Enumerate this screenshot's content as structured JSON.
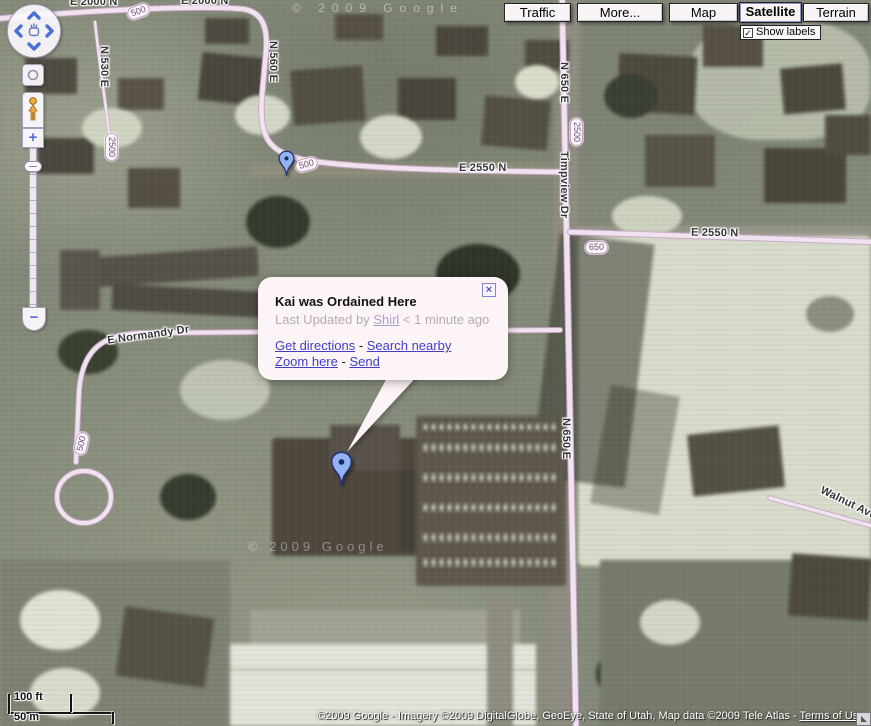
{
  "toolbar": {
    "traffic": "Traffic",
    "more": "More...",
    "map": "Map",
    "satellite": "Satellite",
    "terrain": "Terrain",
    "show_labels": "Show labels",
    "check_glyph": "✓"
  },
  "zoom_control": {
    "plus": "+",
    "minus": "−"
  },
  "bubble": {
    "title": "Kai was Ordained Here",
    "updated_prefix": "Last Updated by ",
    "author": "Shirl",
    "updated_suffix": " < 1 minute ago",
    "get_directions": "Get directions",
    "search_nearby": "Search nearby",
    "zoom_here": "Zoom here",
    "send": "Send",
    "dash": " - ",
    "close": "×"
  },
  "map_labels": {
    "roads": [
      "E 2000 N",
      "E 2000 N",
      "N 530 E",
      "N 560 E",
      "E 2550 N",
      "Timpview Dr",
      "N 650 E",
      "E 2550 N",
      "E Normandy Dr",
      "N 650 E",
      "Walnut Ave"
    ],
    "badges": [
      "500",
      "2500",
      "500",
      "2500",
      "650",
      "500"
    ]
  },
  "scale": {
    "imperial": "100 ft",
    "metric": "50 m"
  },
  "attribution": {
    "text": "©2009 Google - Imagery ©2009 DigitalGlobe, GeoEye, State of Utah, Map data ©2009 Tele Atlas - ",
    "terms": "Terms of Use"
  },
  "watermarks": {
    "top": "© 2009 Google",
    "middle": "© 2009 Google"
  },
  "colors": {
    "road_fill": "#f0e2ef",
    "road_casing": "#c9a6c6",
    "pin_fill": "#93b2f2",
    "pin_stroke": "#27336e",
    "link": "#4141c8",
    "accent_blue": "#4a70d8",
    "bubble_bg": "#fdf4f7"
  }
}
